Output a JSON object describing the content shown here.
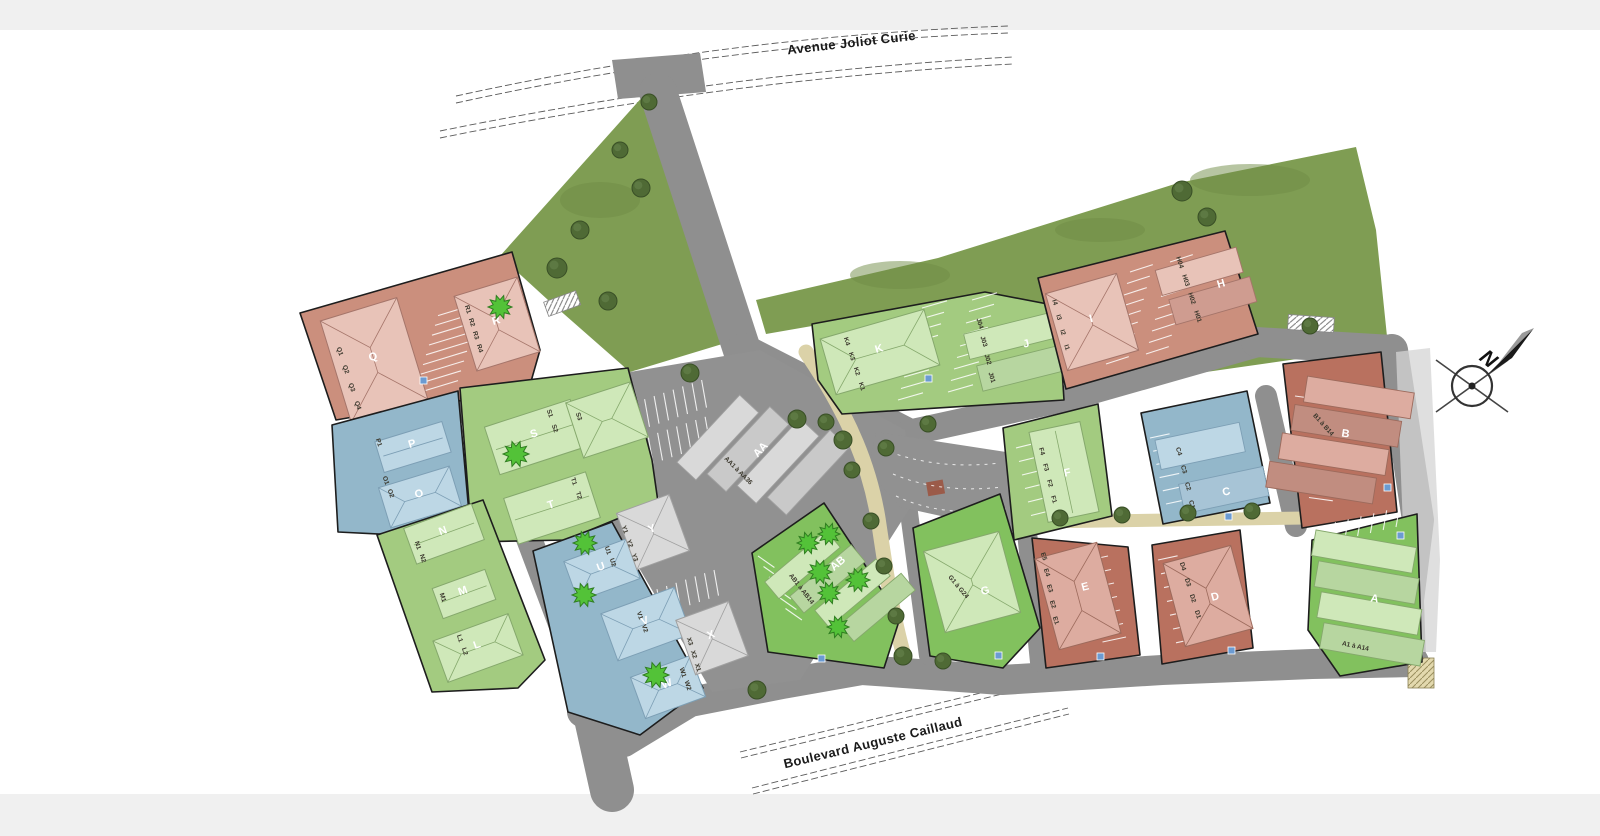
{
  "streets": {
    "avenue": "Avenue Joliot Curie",
    "boulevard": "Boulevard Auguste Caillaud"
  },
  "compass": {
    "north_label": "N"
  },
  "colors": {
    "band": "#f0f0f0",
    "road": "#8f8f8f",
    "lot_gray": "#919191",
    "lawn": "#7f9d53",
    "sidewalk": "#d4d4d4",
    "path_tan": "#dbd2a8",
    "parcel_pink": "#cb8f7d",
    "parcel_red": "#b9715f",
    "parcel_green": "#a3cb80",
    "parcel_green_bright": "#82c15e",
    "parcel_blue": "#93b7ca",
    "tree_dark": "#4f6a35",
    "tree_bright": "#53c238",
    "stripe": "#ffffff",
    "marker_blue": "#6b9bd2",
    "kiosk": "#9b5b49"
  },
  "parcels": [
    {
      "id": "q-r",
      "buildings": [
        {
          "letter": "Q",
          "units": [
            "Q1",
            "Q2",
            "Q3",
            "Q4"
          ]
        },
        {
          "letter": "R",
          "units": [
            "R1",
            "R2",
            "R3",
            "R4"
          ]
        }
      ]
    },
    {
      "id": "p-o",
      "buildings": [
        {
          "letter": "P",
          "units": [
            "P1"
          ]
        },
        {
          "letter": "O",
          "units": [
            "O1",
            "O2"
          ]
        }
      ]
    },
    {
      "id": "s-t",
      "buildings": [
        {
          "letter": "S",
          "units": [
            "S1",
            "S2",
            "S3"
          ]
        },
        {
          "letter": "T",
          "units": [
            "T1",
            "T2"
          ]
        }
      ]
    },
    {
      "id": "n-m-l",
      "buildings": [
        {
          "letter": "N",
          "units": [
            "N1",
            "N2"
          ]
        },
        {
          "letter": "M",
          "units": [
            "M1"
          ]
        },
        {
          "letter": "L",
          "units": [
            "L1",
            "L2"
          ]
        }
      ]
    },
    {
      "id": "u-v-w",
      "buildings": [
        {
          "letter": "U",
          "units": [
            "U1",
            "U2"
          ]
        },
        {
          "letter": "V",
          "units": [
            "V1",
            "V2"
          ]
        },
        {
          "letter": "W",
          "units": [
            "W1",
            "W2"
          ]
        }
      ]
    },
    {
      "id": "central",
      "buildings": [
        {
          "letter": "AA",
          "range": "AA1 à AA36"
        },
        {
          "letter": "Y",
          "units": [
            "Y1",
            "Y2",
            "Y3"
          ]
        },
        {
          "letter": "X",
          "units": [
            "X1",
            "X2",
            "X3"
          ]
        }
      ]
    },
    {
      "id": "k-j",
      "buildings": [
        {
          "letter": "K",
          "units": [
            "K1",
            "K2",
            "K3",
            "K4"
          ]
        },
        {
          "letter": "J",
          "units": [
            "J01",
            "J02",
            "J03",
            "J04"
          ]
        }
      ]
    },
    {
      "id": "i-h",
      "buildings": [
        {
          "letter": "I",
          "units": [
            "I1",
            "I2",
            "I3",
            "I4"
          ]
        },
        {
          "letter": "H",
          "units": [
            "H01",
            "H02",
            "H03",
            "H04"
          ]
        }
      ]
    },
    {
      "id": "c",
      "buildings": [
        {
          "letter": "C",
          "units": [
            "C1",
            "C2",
            "C3",
            "C4"
          ]
        }
      ]
    },
    {
      "id": "f",
      "buildings": [
        {
          "letter": "F",
          "units": [
            "F1",
            "F2",
            "F3",
            "F4"
          ]
        }
      ]
    },
    {
      "id": "b",
      "buildings": [
        {
          "letter": "B",
          "range": "B1 à B14"
        }
      ]
    },
    {
      "id": "ab",
      "buildings": [
        {
          "letter": "AB",
          "range": "AB1 à AB14"
        }
      ]
    },
    {
      "id": "g",
      "buildings": [
        {
          "letter": "G",
          "range": "G1 à G24"
        }
      ]
    },
    {
      "id": "e",
      "buildings": [
        {
          "letter": "E",
          "units": [
            "E1",
            "E2",
            "E3",
            "E4",
            "E5"
          ]
        }
      ]
    },
    {
      "id": "d",
      "buildings": [
        {
          "letter": "D",
          "units": [
            "D1",
            "D2",
            "D3",
            "D4"
          ]
        }
      ]
    },
    {
      "id": "a",
      "buildings": [
        {
          "letter": "A",
          "range": "A1 à A14"
        }
      ]
    }
  ]
}
